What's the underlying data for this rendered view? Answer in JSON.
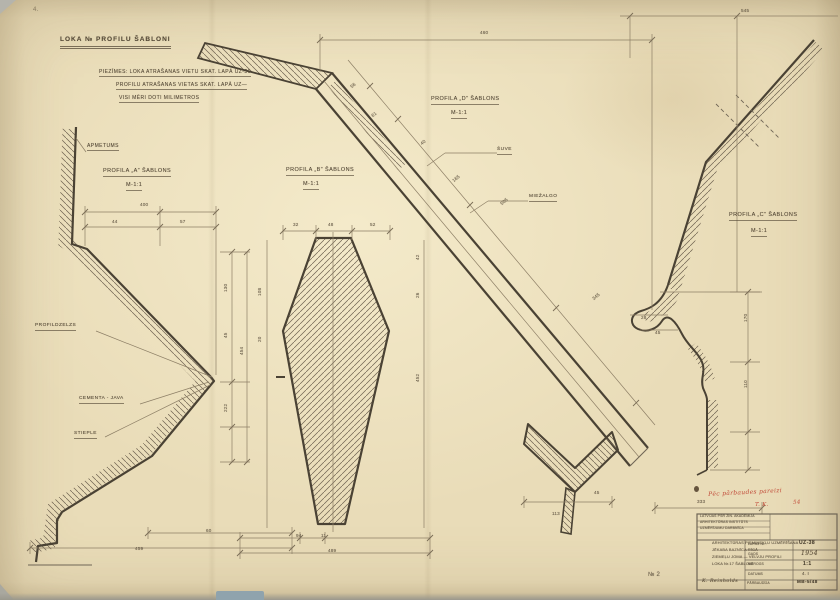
{
  "colors": {
    "paper": "#e9dcb8",
    "line": "#4a4234",
    "pencil": "#564a38",
    "dim_text": "#6b5f4c",
    "red_note": "#c14a38",
    "hatch": "#6e6150"
  },
  "sheet": {
    "header": {
      "title": {
        "name": "sheet-title",
        "text": "LOKA №  PROFILU ŠABLONI",
        "x": 60,
        "y": 37,
        "size": 6.5,
        "cls": "head u2"
      },
      "notes": [
        {
          "name": "note-1",
          "text": "PIEZĪMES:  LOKA ATRAŠANAS VIETU SKAT. LAPĀ  UZ-36",
          "x": 99,
          "y": 70,
          "size": 5,
          "cls": "u"
        },
        {
          "name": "note-2",
          "text": "PROFILU ATRAŠANAS VIETAS SKAT. LAPĀ  UZ—",
          "x": 116,
          "y": 83,
          "size": 5,
          "cls": "u"
        },
        {
          "name": "note-3",
          "text": "VISI MĒRI DOTI MILIMETROS",
          "x": 119,
          "y": 96,
          "size": 5,
          "cls": "u"
        }
      ]
    },
    "profile_titles": [
      {
        "name": "profile-a-title",
        "text": "PROFILA „A”  ŠABLONS",
        "x": 103,
        "y": 169,
        "size": 5.5,
        "cls": "u"
      },
      {
        "name": "profile-a-scale",
        "text": "M-1:1",
        "x": 126,
        "y": 183,
        "size": 5.5,
        "cls": "u"
      },
      {
        "name": "profile-b-title",
        "text": "PROFILA „B”  ŠABLONS",
        "x": 286,
        "y": 168,
        "size": 5.5,
        "cls": "u"
      },
      {
        "name": "profile-b-scale",
        "text": "M-1:1",
        "x": 303,
        "y": 182,
        "size": 5.5,
        "cls": "u"
      },
      {
        "name": "profile-d-title",
        "text": "PROFILA „D”  ŠABLONS",
        "x": 431,
        "y": 97,
        "size": 5.5,
        "cls": "u"
      },
      {
        "name": "profile-d-scale",
        "text": "M-1:1",
        "x": 451,
        "y": 111,
        "size": 5.5,
        "cls": "u"
      },
      {
        "name": "profile-c-title",
        "text": "PROFILA „C”  ŠABLONS",
        "x": 729,
        "y": 213,
        "size": 5.5,
        "cls": "u"
      },
      {
        "name": "profile-c-scale",
        "text": "M-1:1",
        "x": 751,
        "y": 229,
        "size": 5.5,
        "cls": "u"
      }
    ],
    "callouts": [
      {
        "name": "callout-apmetums",
        "text": "APMETUMS",
        "x": 87,
        "y": 144,
        "size": 5,
        "cls": "u"
      },
      {
        "name": "callout-suve",
        "text": "ŠUVE",
        "x": 497,
        "y": 148,
        "size": 4.8,
        "cls": "u"
      },
      {
        "name": "callout-miezalgo",
        "text": "MIEŽALGO",
        "x": 529,
        "y": 195,
        "size": 4.8,
        "cls": "u"
      },
      {
        "name": "callout-profildzelzs",
        "text": "PROFILDZELZS",
        "x": 35,
        "y": 324,
        "size": 4.8,
        "cls": "u"
      },
      {
        "name": "callout-cementa-java",
        "text": "CEMENTA - JAVA",
        "x": 79,
        "y": 397,
        "size": 4.8,
        "cls": "u"
      },
      {
        "name": "callout-stieple",
        "text": "STIEPLE",
        "x": 74,
        "y": 432,
        "size": 4.8,
        "cls": "u"
      }
    ],
    "dimensions": [
      {
        "name": "dim-460",
        "text": "460",
        "x": 480,
        "y": 31,
        "size": 4.6,
        "cls": "dim"
      },
      {
        "name": "dim-545",
        "text": "545",
        "x": 741,
        "y": 9,
        "size": 4.6,
        "cls": "dim"
      },
      {
        "name": "dim-56",
        "text": "56",
        "x": 350,
        "y": 86,
        "size": 4.6,
        "rot": -40,
        "cls": "dim"
      },
      {
        "name": "dim-61",
        "text": "61",
        "x": 371,
        "y": 115,
        "size": 4.6,
        "rot": -40,
        "cls": "dim"
      },
      {
        "name": "dim-40",
        "text": "40",
        "x": 420,
        "y": 143,
        "size": 4.6,
        "rot": -40,
        "cls": "dim"
      },
      {
        "name": "dim-165",
        "text": "165",
        "x": 452,
        "y": 180,
        "size": 4.6,
        "rot": -40,
        "cls": "dim"
      },
      {
        "name": "dim-505",
        "text": "505",
        "x": 500,
        "y": 203,
        "size": 4.6,
        "rot": -40,
        "cls": "dim"
      },
      {
        "name": "dim-345",
        "text": "345",
        "x": 592,
        "y": 298,
        "size": 4.6,
        "rot": -40,
        "cls": "dim"
      },
      {
        "name": "dim-400",
        "text": "400",
        "x": 140,
        "y": 203,
        "size": 4.6,
        "cls": "dim"
      },
      {
        "name": "dim-44",
        "text": "44",
        "x": 112,
        "y": 220,
        "size": 4.6,
        "cls": "dim"
      },
      {
        "name": "dim-57",
        "text": "57",
        "x": 180,
        "y": 220,
        "size": 4.6,
        "cls": "dim"
      },
      {
        "name": "dim-130",
        "text": "130",
        "x": 224,
        "y": 292,
        "size": 4.6,
        "rot": -90,
        "cls": "dim"
      },
      {
        "name": "dim-45a",
        "text": "45",
        "x": 224,
        "y": 338,
        "size": 4.6,
        "rot": -90,
        "cls": "dim"
      },
      {
        "name": "dim-222",
        "text": "222",
        "x": 224,
        "y": 412,
        "size": 4.6,
        "rot": -90,
        "cls": "dim"
      },
      {
        "name": "dim-454",
        "text": "454",
        "x": 240,
        "y": 355,
        "size": 4.6,
        "rot": -90,
        "cls": "dim"
      },
      {
        "name": "dim-60",
        "text": "60",
        "x": 206,
        "y": 529,
        "size": 4.6,
        "cls": "dim"
      },
      {
        "name": "dim-459",
        "text": "459",
        "x": 135,
        "y": 547,
        "size": 4.6,
        "cls": "dim"
      },
      {
        "name": "dim-32",
        "text": "32",
        "x": 293,
        "y": 223,
        "size": 4.6,
        "cls": "dim"
      },
      {
        "name": "dim-48",
        "text": "48",
        "x": 328,
        "y": 223,
        "size": 4.6,
        "cls": "dim"
      },
      {
        "name": "dim-52",
        "text": "52",
        "x": 370,
        "y": 223,
        "size": 4.6,
        "cls": "dim"
      },
      {
        "name": "dim-108",
        "text": "108",
        "x": 258,
        "y": 296,
        "size": 4.6,
        "rot": -90,
        "cls": "dim"
      },
      {
        "name": "dim-20",
        "text": "20",
        "x": 258,
        "y": 342,
        "size": 4.6,
        "rot": -90,
        "cls": "dim"
      },
      {
        "name": "dim-42",
        "text": "42",
        "x": 416,
        "y": 260,
        "size": 4.6,
        "rot": -90,
        "cls": "dim"
      },
      {
        "name": "dim-26",
        "text": "26",
        "x": 416,
        "y": 298,
        "size": 4.6,
        "rot": -90,
        "cls": "dim"
      },
      {
        "name": "dim-452",
        "text": "452",
        "x": 416,
        "y": 382,
        "size": 4.6,
        "rot": -90,
        "cls": "dim"
      },
      {
        "name": "dim-94",
        "text": "94",
        "x": 296,
        "y": 534,
        "size": 4.6,
        "cls": "dim"
      },
      {
        "name": "dim-11",
        "text": "11",
        "x": 321,
        "y": 534,
        "size": 4.6,
        "cls": "dim"
      },
      {
        "name": "dim-489",
        "text": "489",
        "x": 328,
        "y": 549,
        "size": 4.6,
        "cls": "dim"
      },
      {
        "name": "dim-113",
        "text": "113",
        "x": 552,
        "y": 512,
        "size": 4.6,
        "cls": "dim"
      },
      {
        "name": "dim-45b",
        "text": "45",
        "x": 594,
        "y": 491,
        "size": 4.6,
        "cls": "dim"
      },
      {
        "name": "dim-28",
        "text": "28",
        "x": 641,
        "y": 316,
        "size": 4.6,
        "cls": "dim"
      },
      {
        "name": "dim-45c",
        "text": "45",
        "x": 655,
        "y": 331,
        "size": 4.6,
        "cls": "dim"
      },
      {
        "name": "dim-170",
        "text": "170",
        "x": 744,
        "y": 322,
        "size": 4.6,
        "rot": -90,
        "cls": "dim"
      },
      {
        "name": "dim-110",
        "text": "110",
        "x": 744,
        "y": 388,
        "size": 4.6,
        "rot": -90,
        "cls": "dim"
      },
      {
        "name": "dim-333",
        "text": "333",
        "x": 697,
        "y": 500,
        "size": 4.6,
        "cls": "dim"
      }
    ],
    "annotations": {
      "red_note": [
        {
          "name": "red-note-line1",
          "text": "Pēc pārbaudes pareizi",
          "x": 708,
          "y": 492,
          "size": 6,
          "rot": -3,
          "cls": "red"
        },
        {
          "name": "red-note-initials",
          "text": "T. K.",
          "x": 755,
          "y": 503,
          "size": 5.5,
          "cls": "red"
        },
        {
          "name": "red-note-date",
          "text": "54",
          "x": 793,
          "y": 501,
          "size": 5.5,
          "rot": -4,
          "cls": "red"
        }
      ],
      "page_number": {
        "name": "page-number",
        "text": "№ 2",
        "x": 648,
        "y": 572,
        "size": 6,
        "cls": "dim"
      },
      "corner_mark": {
        "name": "corner-mark",
        "text": "4.",
        "x": 33,
        "y": 7,
        "size": 6,
        "cls": "faint"
      }
    },
    "title_block": {
      "stamp": [
        {
          "name": "stamp-line-1",
          "text": "LATVIJAS PSR ZIN. AKADĒMIJA",
          "x": 700,
          "y": 515,
          "size": 3.4,
          "cls": "tiny"
        },
        {
          "name": "stamp-line-2",
          "text": "ARHITEKTŪRAS INSTITŪTS",
          "x": 700,
          "y": 521,
          "size": 3.4,
          "cls": "tiny"
        },
        {
          "name": "stamp-line-3",
          "text": "UZMĒRĪJUMU DARBNĪCA",
          "x": 700,
          "y": 527,
          "size": 3.4,
          "cls": "tiny"
        }
      ],
      "project": [
        {
          "name": "project-line-1",
          "text": "ARHITEKTŪRAS PIEMINEKĻU UZMĒRĪŠANA",
          "x": 712,
          "y": 541,
          "size": 3.9,
          "cls": "tiny"
        },
        {
          "name": "project-line-2",
          "text": "JĒKABA BAZNĪCA RĪGĀ",
          "x": 712,
          "y": 548,
          "size": 3.9,
          "cls": "tiny"
        },
        {
          "name": "project-line-3",
          "text": "ZIEMEĻU JOMA — VELVJU PROFILI",
          "x": 712,
          "y": 555,
          "size": 3.9,
          "cls": "tiny"
        },
        {
          "name": "project-line-4",
          "text": "LOKA Nr.17 ŠABLONI",
          "x": 712,
          "y": 562,
          "size": 3.9,
          "cls": "tiny"
        }
      ],
      "rows": [
        {
          "label": {
            "name": "row1-label",
            "text": "LAPAS Nr.",
            "x": 748,
            "y": 543,
            "size": 3.4,
            "cls": "tiny"
          },
          "value": {
            "name": "row1-value",
            "text": "UZ-38",
            "x": 799,
            "y": 541,
            "size": 5,
            "cls": "val"
          }
        },
        {
          "label": {
            "name": "row2-label",
            "text": "GADS",
            "x": 748,
            "y": 553,
            "size": 3.4,
            "cls": "tiny"
          },
          "value": {
            "name": "row2-value",
            "text": "1954",
            "x": 801,
            "y": 551,
            "size": 6,
            "cls": "sig"
          }
        },
        {
          "label": {
            "name": "row3-label",
            "text": "MĒROGS",
            "x": 748,
            "y": 563,
            "size": 3.4,
            "cls": "tiny"
          },
          "value": {
            "name": "row3-value",
            "text": "1:1",
            "x": 803,
            "y": 562,
            "size": 5,
            "cls": "val"
          }
        },
        {
          "label": {
            "name": "row4-label",
            "text": "DATUMS",
            "x": 748,
            "y": 573,
            "size": 3.4,
            "cls": "tiny"
          },
          "value": {
            "name": "row4-value",
            "text": "4. I",
            "x": 802,
            "y": 572,
            "size": 4.5,
            "cls": "tiny"
          }
        }
      ],
      "signature": {
        "name": "titleblock-signature",
        "text": "K. Reinholds",
        "x": 702,
        "y": 580,
        "size": 4.8,
        "cls": "sig"
      },
      "bottom_label": {
        "name": "titleblock-bottom-label",
        "text": "PĀRBAUDĪJA",
        "x": 747,
        "y": 582,
        "size": 3.4,
        "cls": "tiny"
      },
      "bottom_value": {
        "name": "titleblock-bottom-value",
        "text": "MB-5/48",
        "x": 797,
        "y": 580,
        "size": 4.6,
        "cls": "val"
      }
    }
  }
}
